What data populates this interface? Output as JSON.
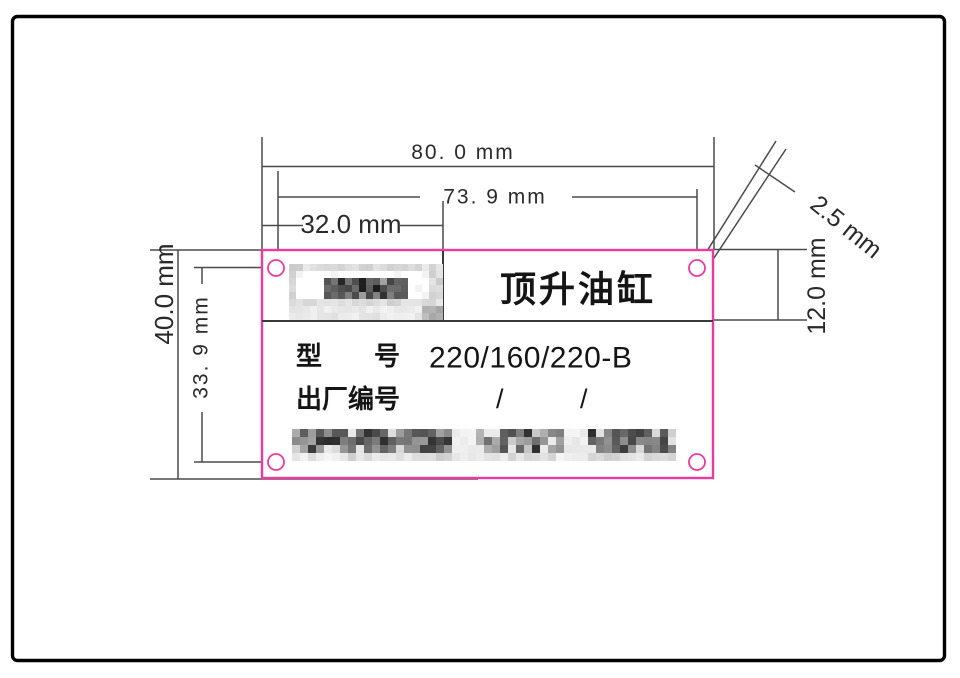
{
  "nameplate": {
    "title": "顶升油缸",
    "model_label": "型　　号",
    "model_value": "220/160/220-B",
    "serial_label": "出厂编号",
    "serial_slash_1": "/",
    "serial_slash_2": "/",
    "logo": "blurred-logo",
    "company_line": "blurred-company-name"
  },
  "dimensions": {
    "plate_width": "80. 0 mm",
    "hole_spacing_horizontal": "73. 9 mm",
    "logo_cell_width": "32.0 mm",
    "plate_height": "40.0 mm",
    "hole_spacing_vertical": "33. 9 mm",
    "title_row_height": "12.0 mm",
    "hole_size": "2.5 mm"
  },
  "colors": {
    "plate_outline": "#ee3a9e",
    "drawing_lines": "#4a4a4a",
    "dimension_text": "#2a2a2a"
  }
}
